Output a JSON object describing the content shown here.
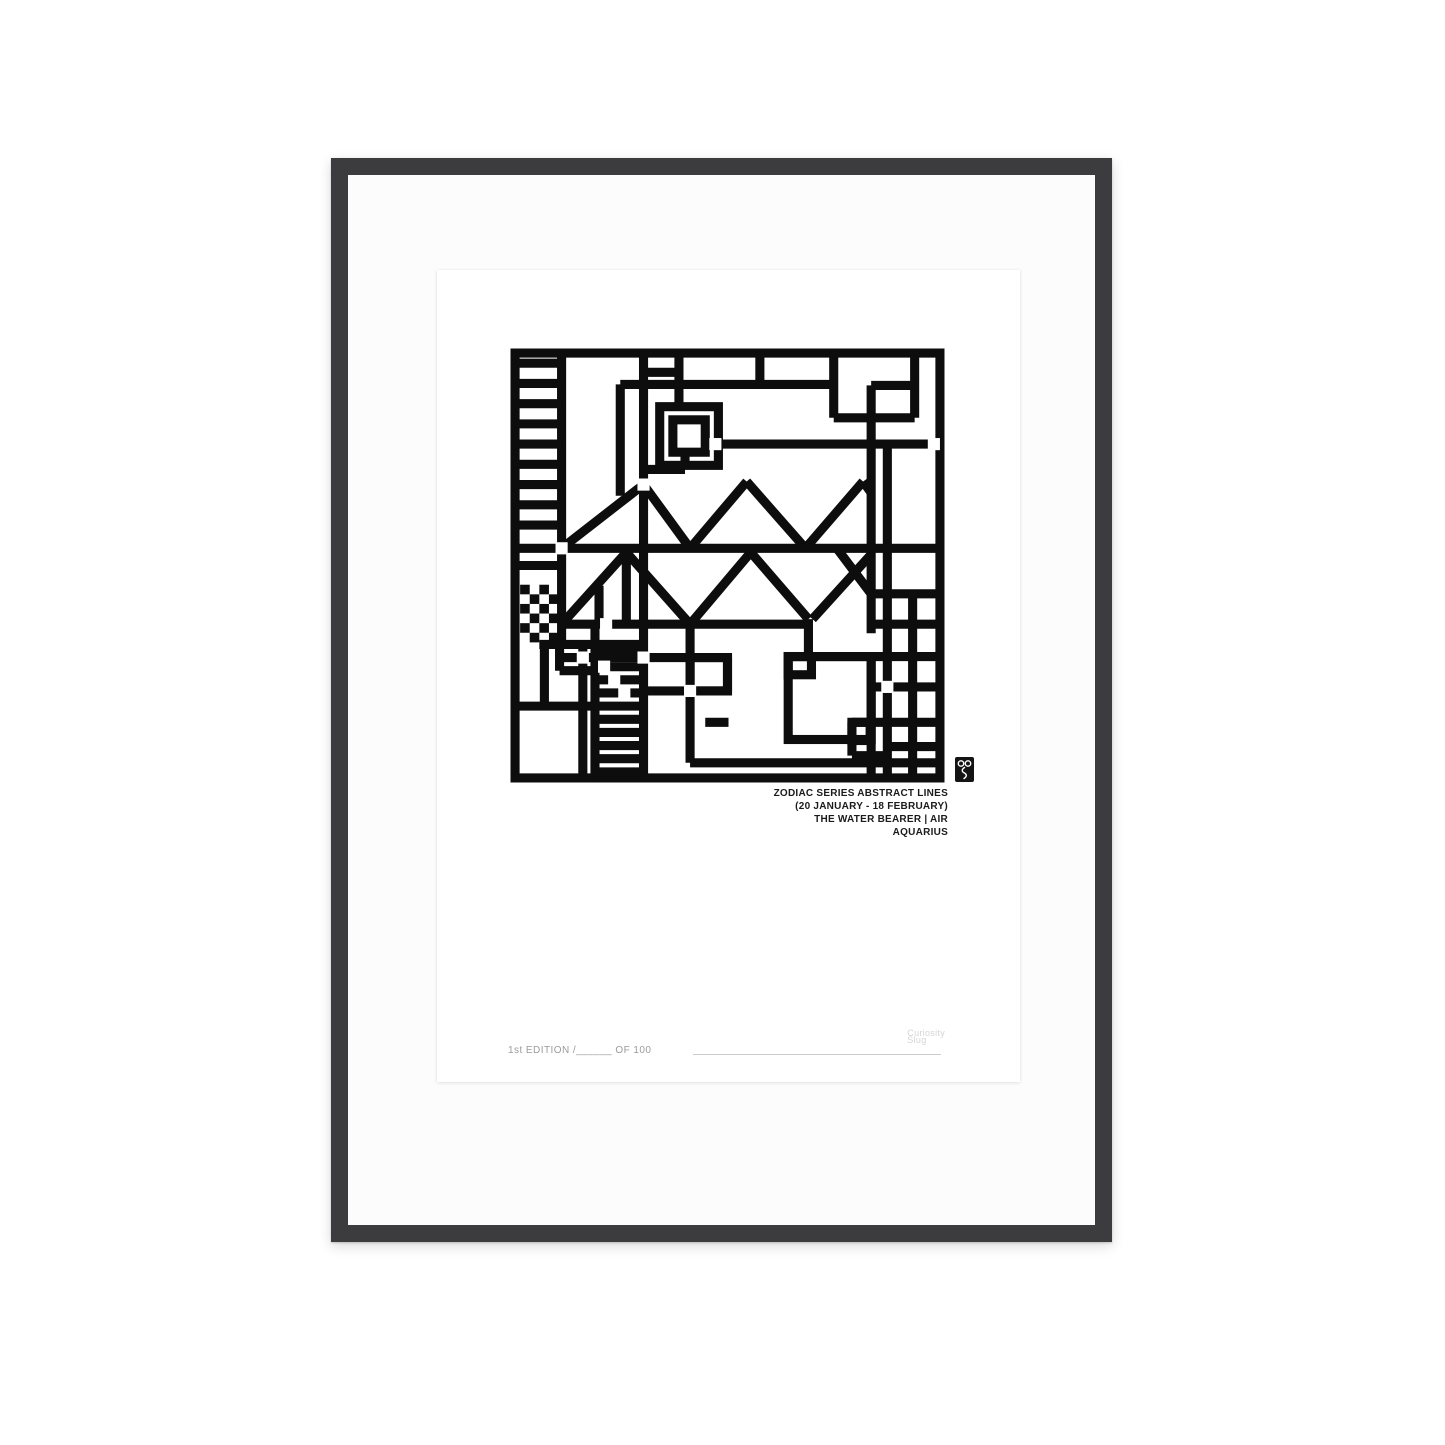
{
  "frame": {
    "color": "#3c3c3e",
    "mat_color": "#fcfcfc",
    "paper_color": "#ffffff"
  },
  "print": {
    "caption": {
      "lines": [
        "ZODIAC SERIES ABSTRACT LINES",
        "(20 JANUARY - 18 FEBRUARY)",
        "THE WATER BEARER | AIR",
        "AQUARIUS"
      ]
    },
    "edition": {
      "text": "1st EDITION /______ OF 100"
    },
    "watermark": {
      "line1": "Curiosity",
      "line2": "Slug"
    },
    "logo_icon": "curiosity-slug-monogram"
  },
  "artwork": {
    "title": "Aquarius abstract geometric line composition",
    "ink": "#0d0d0d",
    "unit": 10,
    "stroke": 9,
    "gap_size": 12,
    "lines": [
      [
        0.5,
        0.05,
        0.5,
        42.95
      ],
      [
        42.5,
        0.05,
        42.5,
        42.95
      ],
      [
        0.05,
        0.5,
        42.95,
        0.5
      ],
      [
        0.05,
        42.5,
        42.95,
        42.5
      ],
      [
        5.1,
        0.5,
        5.1,
        29.3
      ],
      [
        13.2,
        0.5,
        13.2,
        42.5
      ],
      [
        10.9,
        3.6,
        10.9,
        14.6
      ],
      [
        16.7,
        0.5,
        16.7,
        5.8
      ],
      [
        24.7,
        0.5,
        24.7,
        3.7
      ],
      [
        32,
        0.5,
        32,
        6.9
      ],
      [
        40,
        0.5,
        40,
        6.9
      ],
      [
        35.7,
        3.7,
        35.7,
        28.2
      ],
      [
        35.7,
        30.5,
        35.7,
        42.5
      ],
      [
        37.3,
        9.5,
        37.3,
        42.5
      ],
      [
        39.8,
        24.3,
        39.8,
        42.5
      ],
      [
        29.5,
        26.8,
        29.5,
        30.5
      ],
      [
        11.5,
        20.2,
        11.5,
        27.3
      ],
      [
        8.8,
        23.5,
        8.8,
        27.3
      ],
      [
        21.5,
        30.6,
        21.5,
        33.9
      ],
      [
        17.8,
        27.3,
        17.8,
        41.0
      ],
      [
        8.4,
        27.3,
        8.4,
        42.5
      ],
      [
        3.4,
        29.3,
        3.4,
        35.4
      ],
      [
        4.9,
        29.3,
        4.9,
        31.9
      ],
      [
        7.2,
        29.3,
        7.2,
        42.5
      ],
      [
        17.3,
        10.4,
        17.3,
        12.0
      ],
      [
        33.8,
        37.0,
        33.8,
        40.3
      ],
      [
        10.9,
        3.6,
        32,
        3.6
      ],
      [
        35.7,
        3.7,
        40,
        3.7
      ],
      [
        13.2,
        2.4,
        16.7,
        2.4
      ],
      [
        32,
        6.9,
        40,
        6.9
      ],
      [
        19.3,
        9.5,
        42.5,
        9.5
      ],
      [
        13.2,
        12.0,
        17.3,
        12.0
      ],
      [
        0.5,
        19.8,
        42.5,
        19.8
      ],
      [
        35.7,
        24.3,
        42.5,
        24.3
      ],
      [
        4.9,
        27.3,
        29.5,
        27.3
      ],
      [
        35.7,
        27.3,
        42.5,
        27.3
      ],
      [
        2.9,
        29.3,
        13.2,
        29.3
      ],
      [
        27.5,
        30.5,
        42.5,
        30.5
      ],
      [
        4.9,
        30.6,
        21.5,
        30.6
      ],
      [
        4.9,
        31.9,
        8.4,
        31.9
      ],
      [
        35.7,
        33.5,
        42.5,
        33.5
      ],
      [
        13.2,
        33.9,
        21.5,
        33.9
      ],
      [
        0.5,
        35.4,
        8.4,
        35.4
      ],
      [
        19.3,
        37.0,
        21.6,
        37.0
      ],
      [
        33.8,
        37.0,
        42.5,
        37.0
      ],
      [
        33.8,
        40.3,
        37.3,
        40.3
      ],
      [
        37.3,
        39.4,
        42.5,
        39.4
      ],
      [
        17.8,
        41.0,
        42.5,
        41.0
      ],
      [
        5.1,
        19.8,
        13.2,
        13.5
      ],
      [
        13.2,
        13.5,
        17.8,
        19.8
      ],
      [
        17.8,
        19.8,
        23.4,
        13.2
      ],
      [
        23.4,
        13.2,
        29.2,
        19.8
      ],
      [
        29.2,
        19.8,
        34.9,
        13.2
      ],
      [
        34.9,
        13.2,
        35.7,
        14.3
      ],
      [
        5.1,
        27.3,
        11.5,
        20.2
      ],
      [
        11.5,
        20.2,
        17.8,
        27.3
      ],
      [
        17.8,
        27.3,
        23.8,
        20.2
      ],
      [
        23.8,
        20.2,
        29.5,
        26.8
      ],
      [
        29.9,
        26.8,
        35.7,
        20.4
      ],
      [
        32.3,
        19.8,
        35.7,
        24.3
      ],
      [
        0.5,
        1.5,
        5.1,
        1.5
      ],
      [
        0.5,
        3.5,
        5.1,
        3.5
      ],
      [
        0.5,
        5.5,
        5.1,
        5.5
      ],
      [
        0.5,
        7.5,
        5.1,
        7.5
      ],
      [
        0.5,
        9.5,
        5.1,
        9.5
      ],
      [
        0.5,
        11.5,
        5.1,
        11.5
      ],
      [
        0.5,
        13.5,
        5.1,
        13.5
      ],
      [
        0.5,
        15.5,
        5.1,
        15.5
      ],
      [
        0.5,
        17.5,
        5.1,
        17.5
      ],
      [
        0.5,
        21.5,
        5.1,
        21.5
      ],
      [
        8.4,
        30.2,
        13.2,
        30.2
      ],
      [
        8.4,
        31.5,
        13.2,
        31.5
      ],
      [
        8.4,
        32.8,
        13.2,
        32.8
      ],
      [
        8.4,
        34.1,
        13.2,
        34.1
      ],
      [
        8.4,
        35.4,
        13.2,
        35.4
      ],
      [
        8.4,
        36.7,
        13.2,
        36.7
      ],
      [
        8.4,
        38.0,
        13.2,
        38.0
      ],
      [
        8.4,
        39.3,
        13.2,
        39.3
      ],
      [
        8.4,
        40.6,
        13.2,
        40.6
      ],
      [
        8.4,
        41.9,
        13.2,
        41.9
      ]
    ],
    "rects": [
      [
        14.8,
        5.8,
        5.8,
        5.8
      ],
      [
        16.1,
        7.1,
        3.2,
        3.2
      ],
      [
        27.5,
        30.5,
        8.2,
        8.2
      ],
      [
        27.5,
        30.5,
        2.3,
        1.8
      ],
      [
        33.8,
        37.0,
        1.8,
        1.8
      ],
      [
        17.8,
        30.6,
        3.7,
        3.3
      ]
    ],
    "gaps": [
      [
        5.1,
        19.8
      ],
      [
        13.2,
        13.5
      ],
      [
        20.3,
        9.5
      ],
      [
        41.9,
        9.5
      ],
      [
        9.5,
        27.3
      ],
      [
        7.2,
        30.6
      ],
      [
        13.2,
        30.6
      ],
      [
        17.8,
        33.9
      ],
      [
        37.3,
        33.5
      ],
      [
        9.3,
        31.5
      ],
      [
        10.3,
        32.8
      ],
      [
        11.3,
        34.1
      ]
    ],
    "checker_cells": [
      [
        1.0,
        23.4
      ],
      [
        2.9,
        23.4
      ],
      [
        1.95,
        24.35
      ],
      [
        3.85,
        24.35
      ],
      [
        1.0,
        25.3
      ],
      [
        2.9,
        25.3
      ],
      [
        1.95,
        26.25
      ],
      [
        3.85,
        26.25
      ],
      [
        1.0,
        27.2
      ],
      [
        2.9,
        27.2
      ],
      [
        1.95,
        28.15
      ],
      [
        3.85,
        28.15
      ]
    ]
  }
}
